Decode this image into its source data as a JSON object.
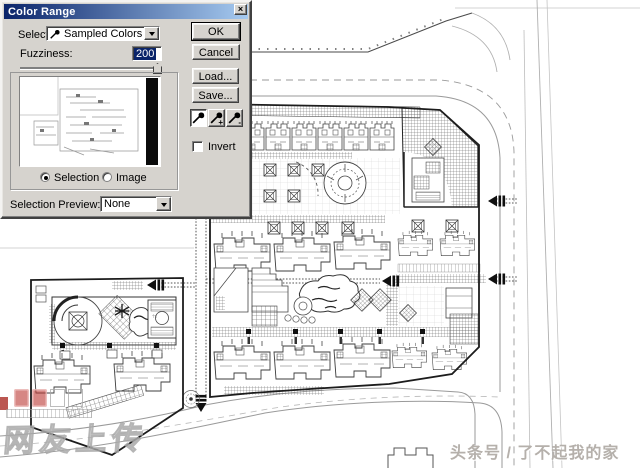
{
  "dialog": {
    "title": "Color Range",
    "close_glyph": "×",
    "select_label": "Select:",
    "select_value": "Sampled Colors",
    "fuzziness_label": "Fuzziness:",
    "fuzziness_value": "200",
    "selection_radio_label": "Selection",
    "image_radio_label": "Image",
    "selected_preview_mode": "Selection",
    "selection_preview_label": "Selection Preview:",
    "selection_preview_value": "None",
    "ok_label": "OK",
    "cancel_label": "Cancel",
    "load_label": "Load...",
    "save_label": "Save...",
    "invert_label": "Invert",
    "invert_checked": false,
    "eyedropper_plus_glyph": "+",
    "eyedropper_minus_glyph": "-"
  },
  "watermarks": {
    "uploader_text": "网友上传",
    "credit_text": "头条号 / 了不起我的家"
  },
  "colors": {
    "titlebar_left": "#0a246a",
    "titlebar_right": "#a6caf0",
    "dialog_face": "#d6d3ce",
    "highlight": "#0a246a",
    "watermark_red": "#bd3e38"
  }
}
